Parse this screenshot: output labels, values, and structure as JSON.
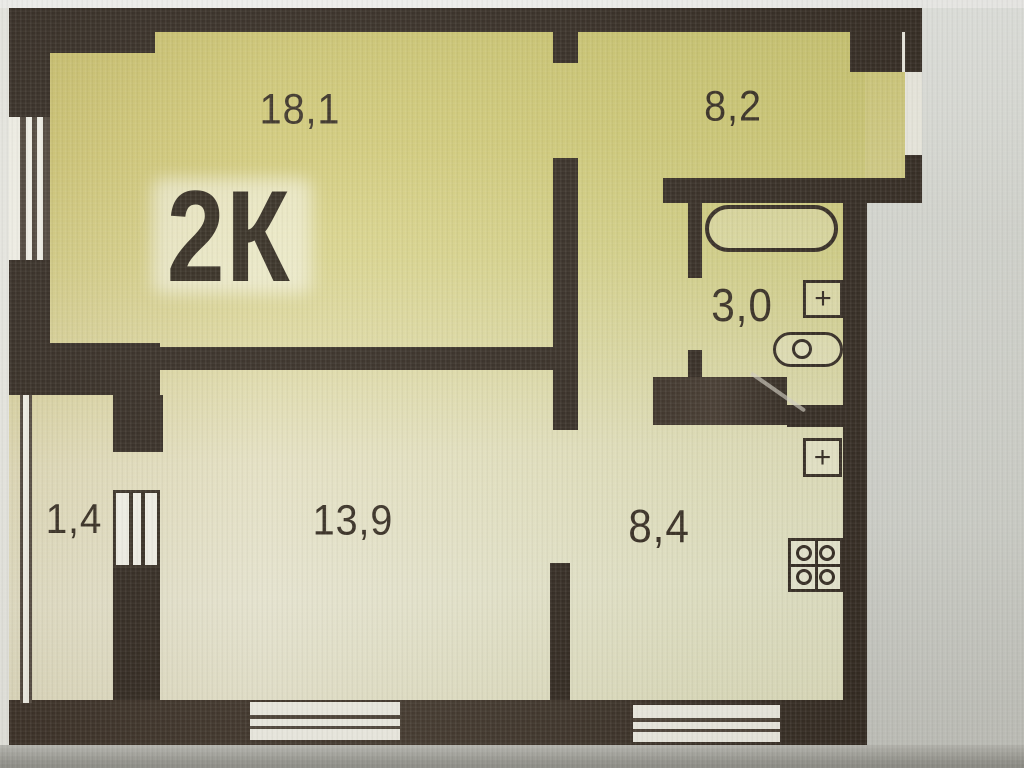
{
  "plan": {
    "title_label": "2К",
    "rooms": [
      {
        "name": "living-room",
        "area": "18,1"
      },
      {
        "name": "room-2",
        "area": "8,2"
      },
      {
        "name": "bathroom",
        "area": "3,0"
      },
      {
        "name": "closet",
        "area": "1,4"
      },
      {
        "name": "hall",
        "area": "13,9"
      },
      {
        "name": "kitchen",
        "area": "8,4"
      }
    ]
  },
  "colors": {
    "wall": "#2e251d",
    "paper_top": "#ccc46f",
    "paper_bottom": "#edebd6",
    "photo_margin": "#d6d8d2",
    "label_text": "#32291e"
  }
}
